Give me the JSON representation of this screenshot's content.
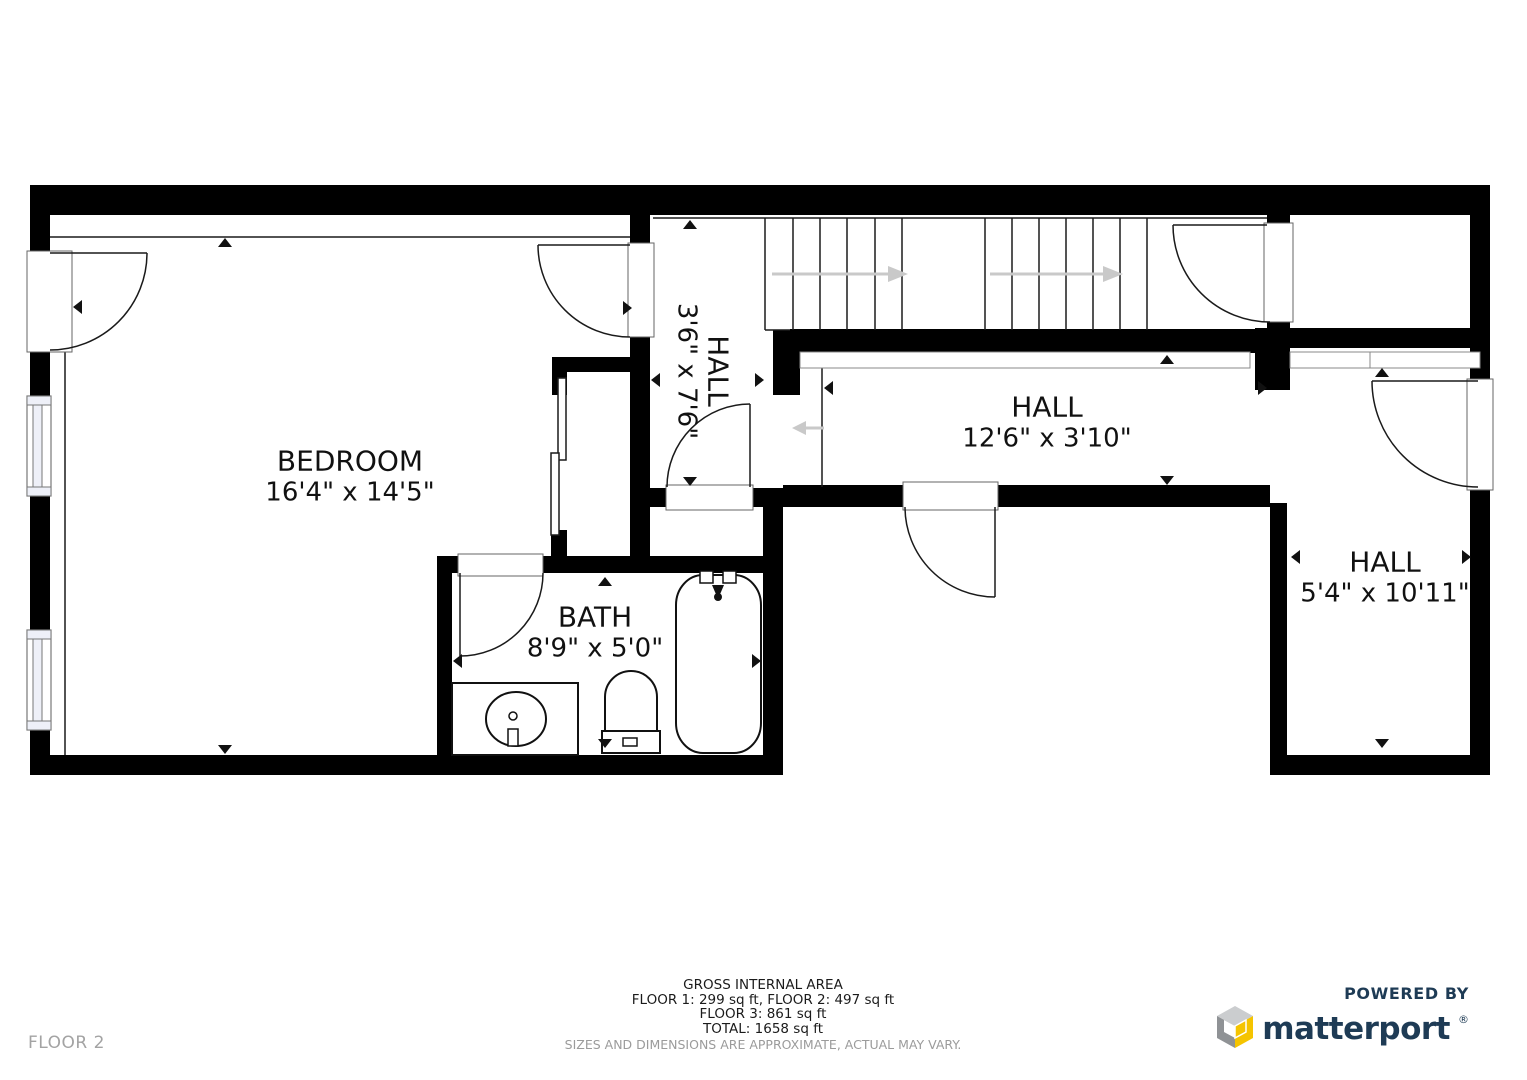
{
  "floorplan": {
    "rooms": {
      "bedroom": {
        "name": "BEDROOM",
        "dims": "16'4\" x 14'5\""
      },
      "bath": {
        "name": "BATH",
        "dims": "8'9\" x 5'0\""
      },
      "hall_upper": {
        "name": "HALL",
        "dims": "3'6\" x 7'6\""
      },
      "hall_middle": {
        "name": "HALL",
        "dims": "12'6\" x 3'10\""
      },
      "hall_right": {
        "name": "HALL",
        "dims": "5'4\" x 10'11\""
      }
    },
    "fixtures": [
      "staircase",
      "bathtub",
      "toilet",
      "sink-vanity",
      "sliding-closet-doors",
      "windows",
      "door-swings"
    ]
  },
  "footer": {
    "floor_label": "FLOOR 2",
    "gross_internal_area_title": "GROSS INTERNAL AREA",
    "area_line_1": "FLOOR 1: 299 sq ft, FLOOR 2: 497 sq ft",
    "area_line_2": "FLOOR 3: 861 sq ft",
    "area_line_3": "TOTAL: 1658 sq ft",
    "disclaimer": "SIZES AND DIMENSIONS ARE APPROXIMATE, ACTUAL MAY VARY."
  },
  "branding": {
    "powered_by": "POWERED BY",
    "brand": "matterport",
    "registered_mark": "®"
  },
  "colors": {
    "wall": "#000000",
    "dimension_arrow": "#111111",
    "stair_arrow": "#c9c9c9",
    "brand_navy": "#1e3b55",
    "accent_yellow": "#f5c400",
    "cube_gray_light": "#cbcdcf",
    "cube_gray_dark": "#8f9295",
    "muted_text": "#9b9b9b",
    "window_tint": "#eef0f8"
  }
}
